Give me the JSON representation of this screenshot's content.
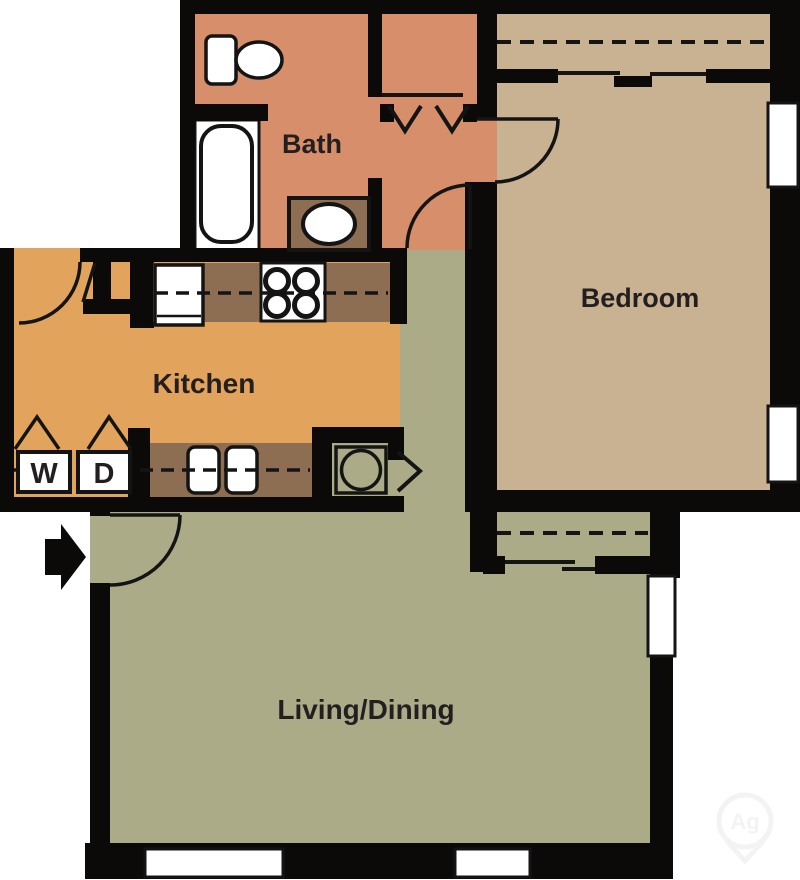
{
  "plan": {
    "rooms": {
      "bath": {
        "label": "Bath"
      },
      "bedroom": {
        "label": "Bedroom"
      },
      "kitchen": {
        "label": "Kitchen"
      },
      "living": {
        "label": "Living/Dining"
      }
    },
    "appliances": {
      "washer": "W",
      "dryer": "D"
    },
    "watermark": "Ag"
  },
  "colors": {
    "bath": "#D78E6A",
    "bedroom": "#C9B292",
    "kitchen": "#E2A45C",
    "living": "#ABAC87",
    "counter": "#8D6E53",
    "wall": "#0B0A08",
    "fixture": "#FFFFFF",
    "label_text": "#231F20"
  }
}
